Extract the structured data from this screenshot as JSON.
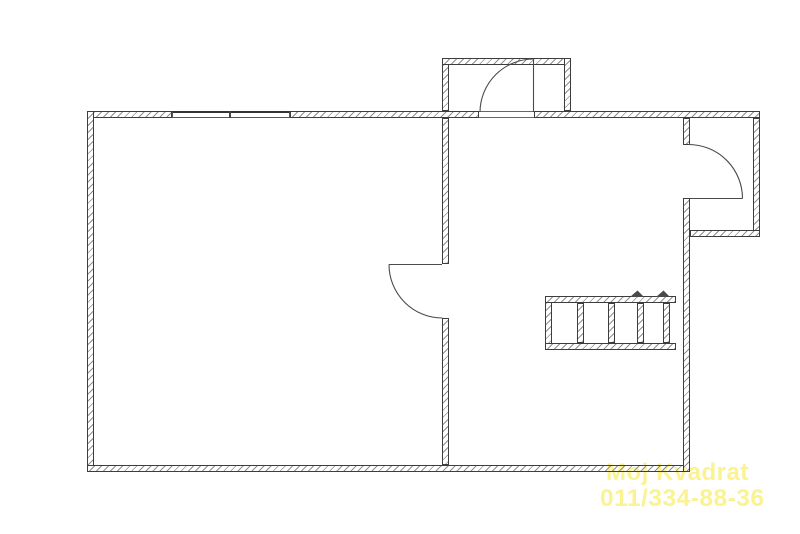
{
  "watermark": {
    "line1": "Moj Kvadrat",
    "line2": "011/334-88-36",
    "color": "#FBF291"
  },
  "colors": {
    "background": "#FFFFFF",
    "wall_edge": "#3D3D3D",
    "hatch": "#8F8F8F",
    "door_line": "#4A4A4A"
  }
}
